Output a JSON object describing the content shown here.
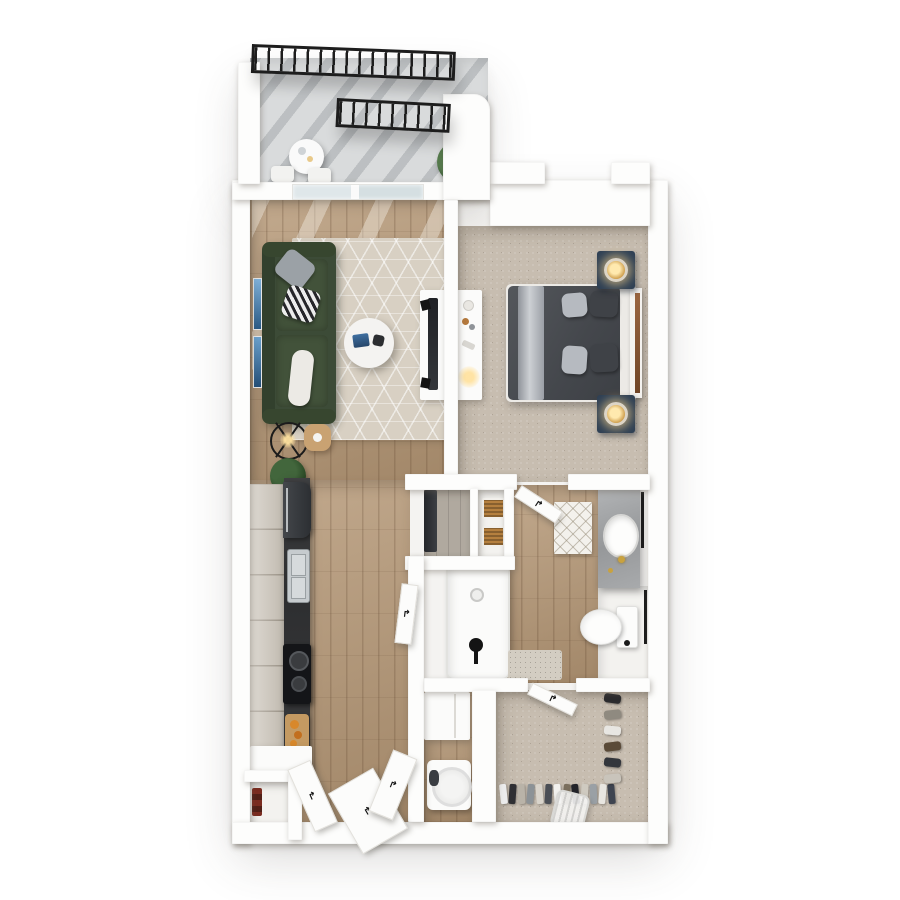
{
  "scene": {
    "title": "3D top-down floor plan of a one-bedroom apartment with balcony",
    "view": "top-down 3D render, no text labels",
    "background": "#ffffff"
  },
  "palette": {
    "wall": "#fdfdfc",
    "wood_floor": "#b49674",
    "carpet": "#c7bdb0",
    "balcony_concrete": "#d9dbdc",
    "sofa_green": "#3c4b37",
    "nightstand_navy": "#2d3f54",
    "counter_stone": "#3b3c3e",
    "vanity_marble": "#a4a6a8",
    "brass": "#c9a23f",
    "railing_black": "#1d1d1d",
    "art_blue": "#3c6e9e"
  },
  "glyphs": {
    "door_swing_arrow": "↱"
  },
  "rooms": {
    "balcony": {
      "label": "Balcony",
      "floor": "concrete",
      "items": [
        "black metal railing (outer)",
        "black metal railing (inner)",
        "round bistro table",
        "two chairs",
        "potted plant"
      ]
    },
    "living_room": {
      "label": "Living room",
      "floor": "wood plank",
      "items": [
        "dark green sofa with gray, patterned and white pillows",
        "beige geometric area rug",
        "round white coffee table with books",
        "black tripod floor lamp",
        "round wood side table",
        "two blue wall-art frames",
        "sliding glass balcony door",
        "white media console with TV"
      ]
    },
    "bedroom": {
      "label": "Bedroom",
      "floor": "carpet",
      "items": [
        "bed with dark gray duvet, light gray throw and pillows",
        "wood-accent headboard",
        "two navy nightstands with lit brass lamps",
        "white desk with decor and lamp",
        "ceiling vent"
      ]
    },
    "kitchen": {
      "label": "Kitchen",
      "floor": "wood plank",
      "items": [
        "light wood cabinet run",
        "dark stone countertop",
        "refrigerator",
        "stainless sink",
        "black cooktop",
        "cutting board with food",
        "plant"
      ]
    },
    "bathroom": {
      "label": "Bathroom",
      "floor": "wood plank",
      "items": [
        "bathtub with black fixture",
        "diamond-pattern bath mat",
        "gray marble vanity with white sink and brass faucet",
        "toilet",
        "black towel bars",
        "linen shelves with two wood baskets",
        "utility nook"
      ]
    },
    "laundry": {
      "label": "Laundry nook",
      "floor": "wood",
      "items": [
        "upper cabinet",
        "round-drum washer"
      ]
    },
    "walk_in_closet": {
      "label": "Walk-in closet",
      "floor": "carpet",
      "items": [
        "hanging clothes along rod",
        "shoe shelf",
        "clear laundry basket"
      ]
    },
    "entry": {
      "label": "Entry hall",
      "floor": "wood plank",
      "items": [
        "entry door",
        "two closet door panels",
        "small coat closet with red boxes"
      ]
    }
  }
}
